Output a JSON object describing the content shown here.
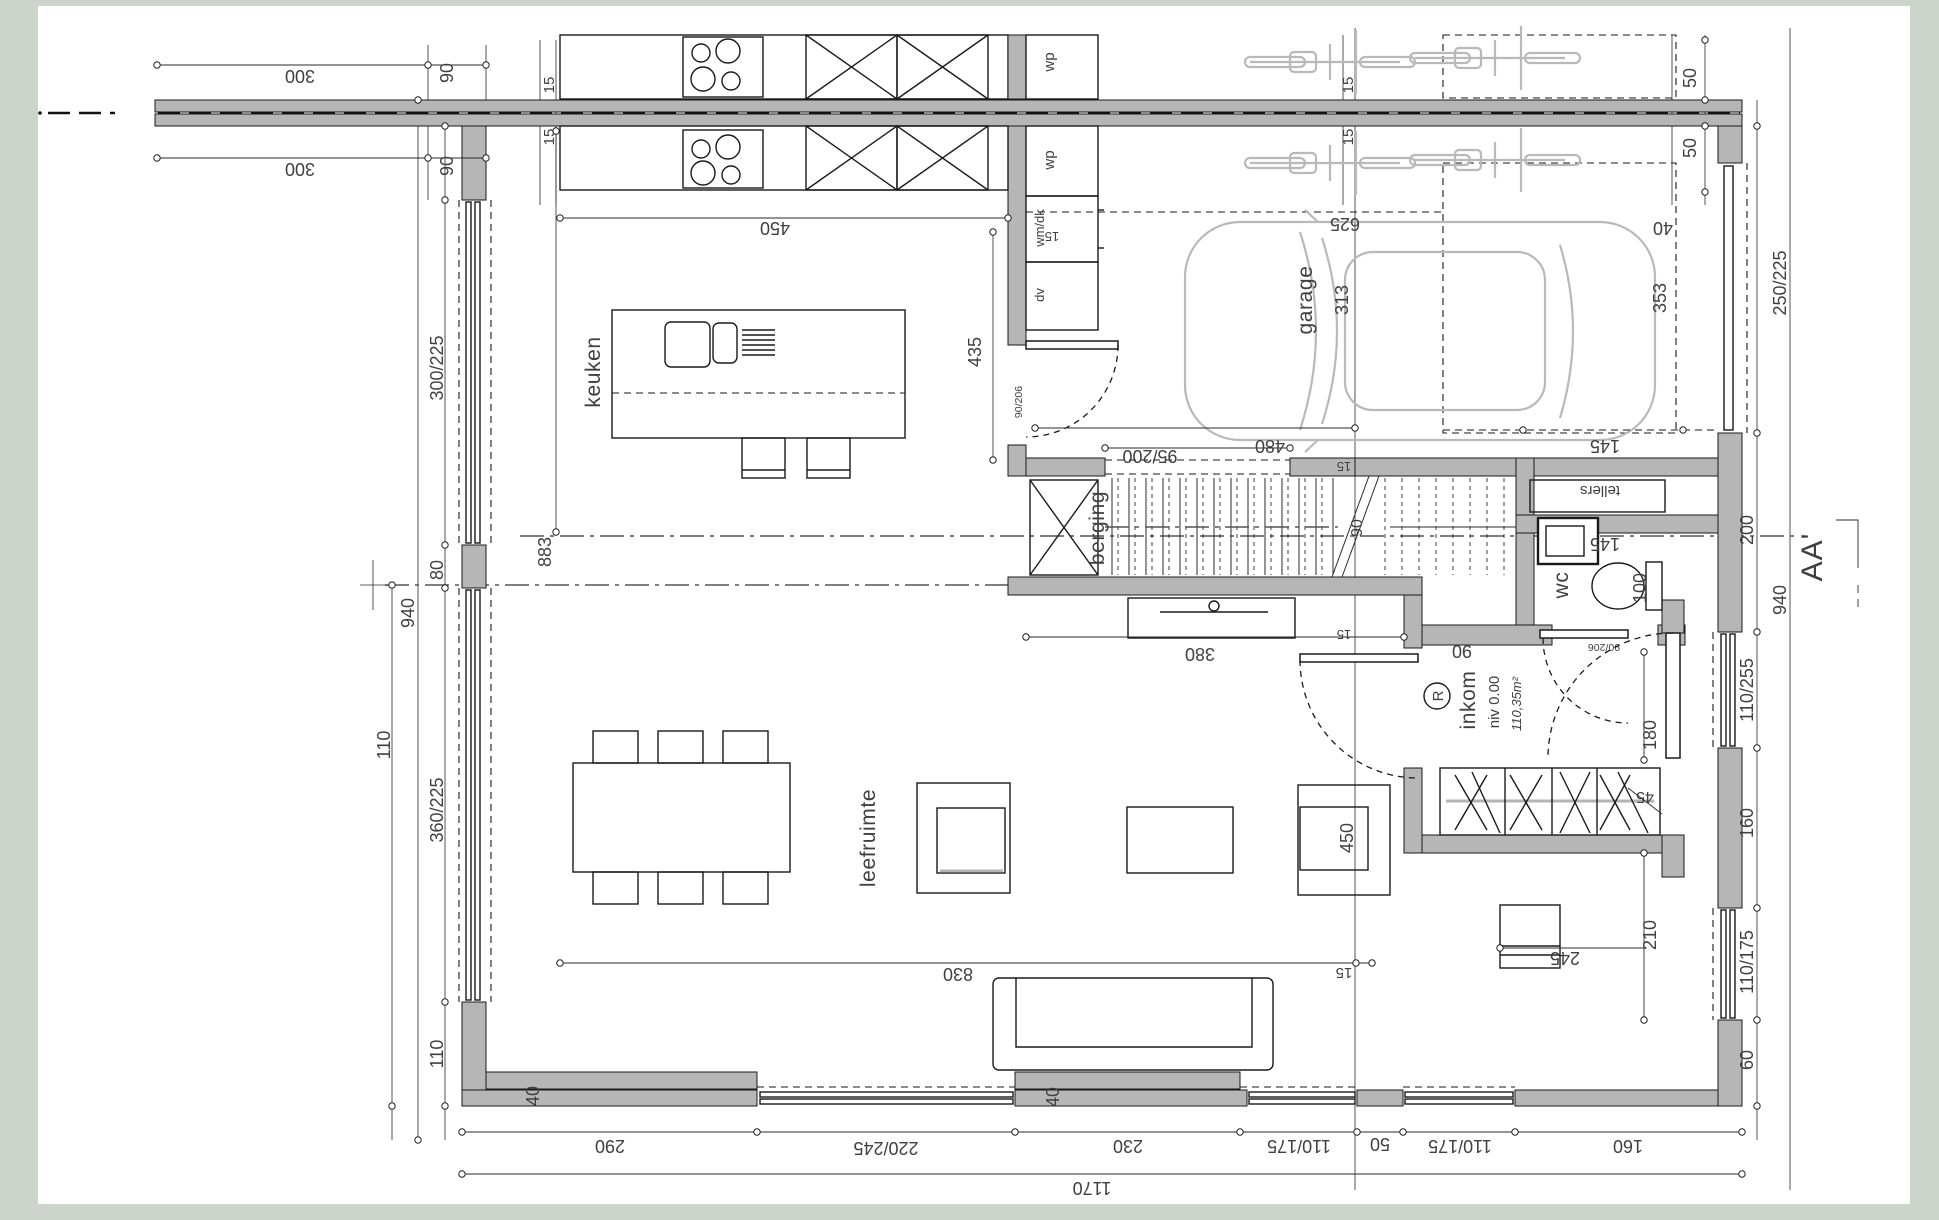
{
  "sheet": {
    "bg": "#cdd4cc",
    "paper": "#ffffff",
    "wall_fill": "#b6b6b6",
    "light_gray": "#b9b9b9",
    "ink": "#1a1a1a",
    "text": "#404040"
  },
  "rooms": {
    "keuken": "keuken",
    "garage": "garage",
    "garage_width": "313",
    "berging": "berging",
    "wc": "wc",
    "tellers": "tellers",
    "inkom": "inkom",
    "inkom_level": "niv 0.00",
    "inkom_area": "110,35m²",
    "ref_mark": "R",
    "leefruimte": "leefruimte"
  },
  "fixtures": {
    "wp_a": "wp",
    "wp_b": "wp",
    "wm_dk": "wm/dk",
    "dv": "dv"
  },
  "section": {
    "label": "AA'"
  },
  "dims": {
    "top300": [
      "300",
      "300"
    ],
    "ninety": [
      "90",
      "90",
      "90",
      "90"
    ],
    "fifteen": [
      "15",
      "15",
      "15",
      "15",
      "15",
      "15",
      "15",
      "15"
    ],
    "forty": [
      "40",
      "40",
      "40"
    ],
    "four50": [
      "450",
      "450"
    ],
    "d435": "435",
    "d625": "625",
    "d353": "353",
    "fifty": [
      "50",
      "50"
    ],
    "d250_225": "250/225",
    "d95_200": "95/200",
    "d480": "480",
    "one45": [
      "145",
      "145"
    ],
    "d100": "100",
    "d380": "380",
    "d180": "180",
    "d45": "45",
    "d210": "210",
    "d245": "245",
    "d830": "830",
    "d90206": [
      "90/206",
      "90/206"
    ],
    "d300_225": "300/225",
    "n940": [
      "940",
      "940"
    ],
    "d80": "80",
    "d883": "883",
    "d360_225": "360/225",
    "one10": [
      "110",
      "110"
    ],
    "d200": "200",
    "d110_255": "110/255",
    "one60": [
      "160",
      "160"
    ],
    "one10_175": [
      "110/175",
      "110/175",
      "110/175"
    ],
    "d60": "60",
    "d290": "290",
    "d220_245": "220/245",
    "d230": "230",
    "d50": "50",
    "d1170": "1170"
  }
}
